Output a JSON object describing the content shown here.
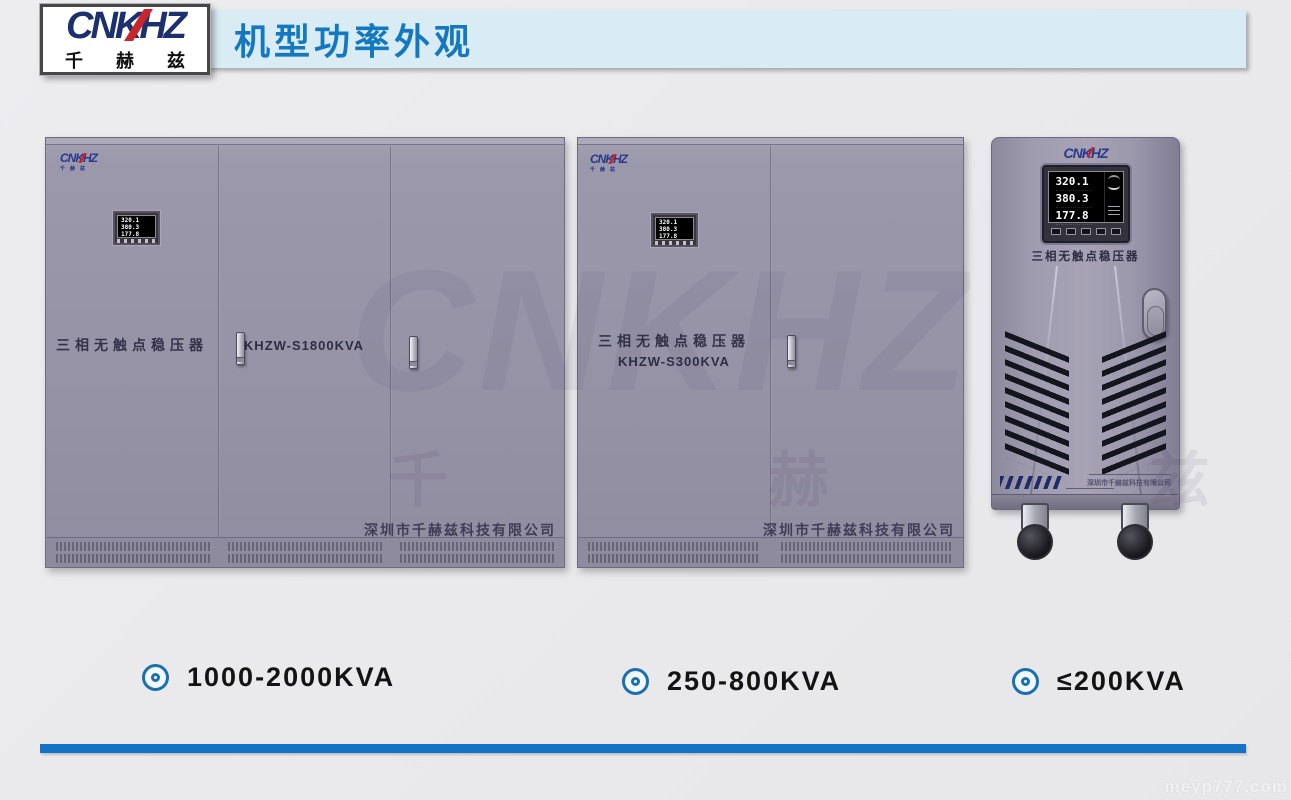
{
  "logo": {
    "text": "CNKHZ",
    "sub": "千 赫 兹"
  },
  "header": {
    "title": "机型功率外观"
  },
  "brand": {
    "text": "CNKHZ",
    "sub": "千赫兹"
  },
  "display": {
    "rows": [
      "320.1",
      "380.3",
      "177.8"
    ]
  },
  "products": [
    {
      "name": "三相无触点稳压器",
      "model": "KHZW-S1800KVA",
      "company": "深圳市千赫兹科技有限公司",
      "power": "1000-2000KVA"
    },
    {
      "name": "三相无触点稳压器",
      "model": "KHZW-S300KVA",
      "company": "深圳市千赫兹科技有限公司",
      "power": "250-800KVA"
    },
    {
      "name": "三相无触点稳压器",
      "company": "深圳市千赫兹科技有限公司",
      "power": "≤200KVA"
    }
  ],
  "watermark": {
    "ghost": "CNKHZ",
    "ghost_cn": "千 赫 兹",
    "site": "meyp777.com"
  },
  "colors": {
    "header_bg": "#d9ecf4",
    "title_blue": "#1478c0",
    "cabinet_gray": "#9793a7",
    "bullet_blue": "#1a6fae",
    "line_blue": "#1273c5",
    "logo_navy": "#1c2f6e",
    "logo_red": "#c9252b"
  }
}
